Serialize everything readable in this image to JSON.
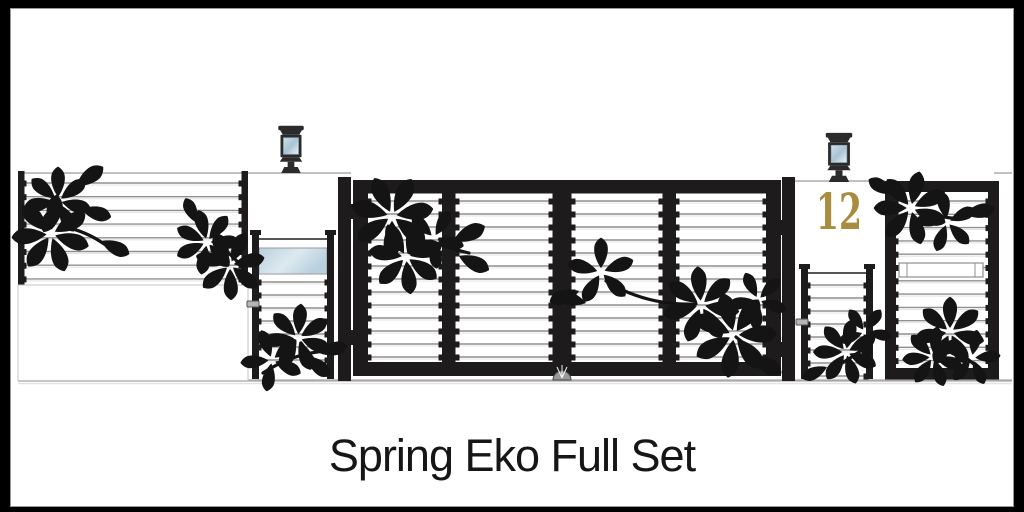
{
  "caption": {
    "text": "Spring Eko Full Set"
  },
  "pillar": {
    "house_number": "12"
  },
  "palette": {
    "frame_black": "#1d1b1b",
    "leaf_black": "#141414",
    "slat_gray": "#8f8f8f",
    "slat_highlight": "#e4e4e4",
    "glass_blue": "#b3cbd9",
    "glass_blue_light": "#e8f2f7",
    "house_number_gold": "#aa8c3e",
    "ground_gray": "#a8a8a8",
    "border_black": "#000000"
  },
  "objects": {
    "left_fence_panel": "fence panel with horizontal slats and leaf motif",
    "left_wall_section": "plain wall section",
    "left_pillar_lamp": "pillar lamp",
    "left_wicket_gate": "small entry gate with glass panel and leaf motif",
    "main_gate": "four-panel double swing gate with slats and leaf motifs",
    "house_number_pillar": "pillar with house number",
    "right_pillar_lamp": "pillar lamp",
    "right_wicket_gate": "small entry gate with leaf motif",
    "right_fence_panel": "framed fence panel with letterbox slot and leaf motifs"
  }
}
